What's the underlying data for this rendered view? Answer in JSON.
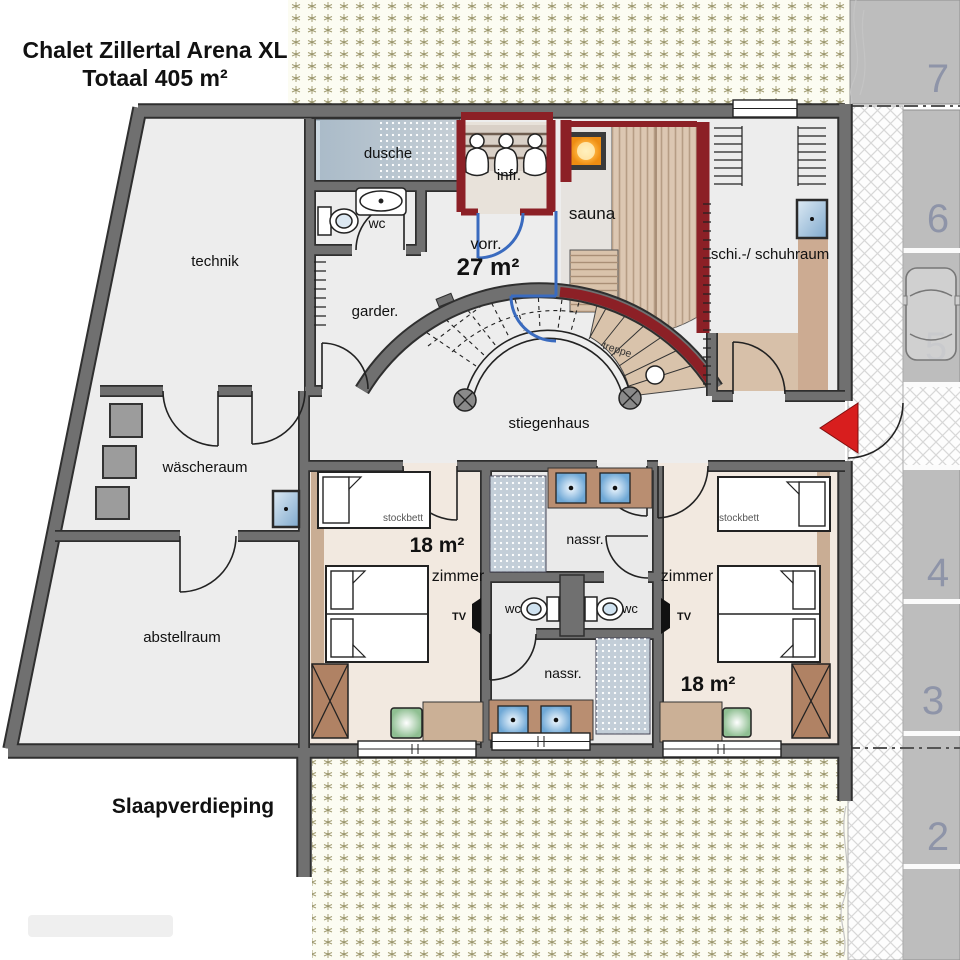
{
  "header": {
    "title_line1": "Chalet Zillertal Arena XL",
    "title_line2": "Totaal 405 m²"
  },
  "footer": {
    "floor_label": "Slaapverdieping"
  },
  "rooms": {
    "technik": "technik",
    "dusche": "dusche",
    "wc_top": "wc",
    "infrared": "infr.",
    "sauna": "sauna",
    "ski_room": "schi.-/ schuhraum",
    "vestibule": "vorr.",
    "vestibule_area": "27 m²",
    "wardrobe": "garder.",
    "laundry": "wäscheraum",
    "storage": "abstellraum",
    "stairwell": "stiegenhaus",
    "stairs": "treppe",
    "bath_top": "nassr.",
    "bath_bottom": "nassr.",
    "wc_left": "wc",
    "wc_right": "wc",
    "bedroom_left": {
      "label": "zimmer",
      "area": "18 m²",
      "bunk": "stockbett",
      "tv": "TV"
    },
    "bedroom_right": {
      "label": "zimmer",
      "area": "18 m²",
      "bunk": "stockbett",
      "tv": "TV"
    }
  },
  "parking": {
    "space_7": "7",
    "space_6": "6",
    "space_5": "5",
    "space_4": "4",
    "space_3": "3",
    "space_2": "2"
  },
  "colors": {
    "wall": "#6e6e6e",
    "wall_outline": "#2f2f2f",
    "sauna_red": "#8c2026",
    "partition_blue": "#3a6bbf",
    "wood": "#d9c3ab",
    "floor": "#ededed",
    "bedroom_floor": "#f2e9e0",
    "tan_furniture": "#c9ad94",
    "shower_blue": "#c3ced8",
    "parking_gray": "#bdbdbd",
    "number_blue": "#8e94a8",
    "accent_red": "#d81e1e",
    "stove_orange": "#f59b1d",
    "appliance_gray": "#9c9c9c",
    "leaf_olive": "#9a9467"
  }
}
